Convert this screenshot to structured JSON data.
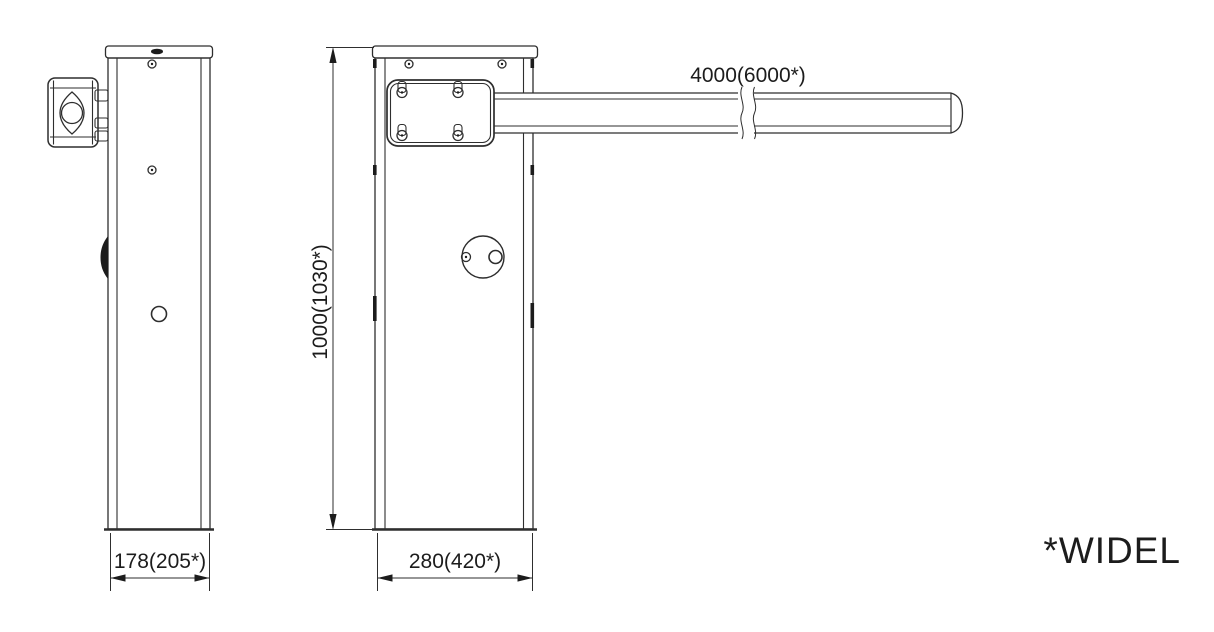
{
  "canvas": {
    "background": "#ffffff",
    "line_color": "#2e2e2e",
    "ink_color": "#1c1c1c",
    "text_color": "#1c1c1c"
  },
  "views": {
    "side": {
      "width_label": "178(205*)"
    },
    "front": {
      "width_label": "280(420*)",
      "height_label": "1000(1030*)"
    },
    "arm": {
      "length_label": "4000(6000*)"
    }
  },
  "footnote": {
    "text": "*WIDEL"
  }
}
